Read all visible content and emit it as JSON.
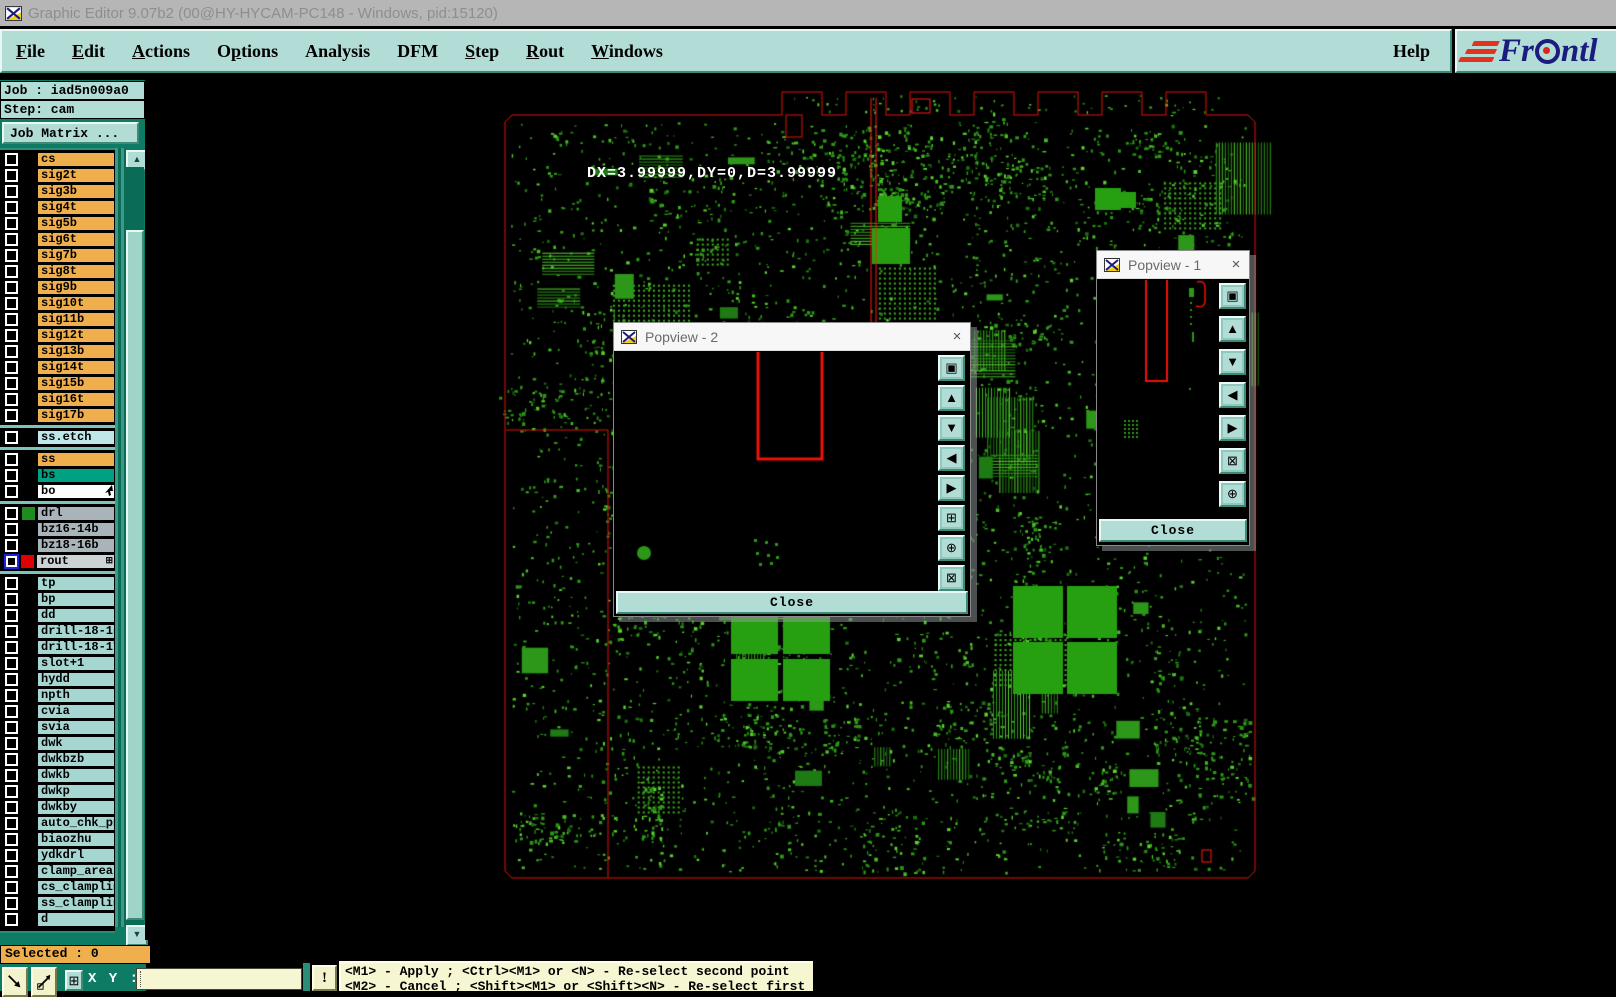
{
  "window": {
    "title": "Graphic Editor 9.07b2 (00@HY-HYCAM-PC148 - Windows, pid:15120)"
  },
  "menu": {
    "items": [
      {
        "label": "File",
        "u": 0
      },
      {
        "label": "Edit",
        "u": 0
      },
      {
        "label": "Actions",
        "u": 0
      },
      {
        "label": "Options",
        "u": 1
      },
      {
        "label": "Analysis",
        "u": -1
      },
      {
        "label": "DFM",
        "u": -1
      },
      {
        "label": "Step",
        "u": 0
      },
      {
        "label": "Rout",
        "u": 0
      },
      {
        "label": "Windows",
        "u": 0
      }
    ],
    "help": {
      "label": "Help"
    }
  },
  "logo": {
    "pre": "Fr",
    "post": "ntl"
  },
  "sidebar": {
    "job": "Job : iad5n009a0",
    "step": "Step: cam",
    "job_matrix": "Job Matrix ...",
    "selected": "Selected : 0",
    "layers": [
      {
        "label": "cs",
        "type": "orange"
      },
      {
        "label": "sig2t",
        "type": "orange"
      },
      {
        "label": "sig3b",
        "type": "orange"
      },
      {
        "label": "sig4t",
        "type": "orange"
      },
      {
        "label": "sig5b",
        "type": "orange"
      },
      {
        "label": "sig6t",
        "type": "orange"
      },
      {
        "label": "sig7b",
        "type": "orange"
      },
      {
        "label": "sig8t",
        "type": "orange"
      },
      {
        "label": "sig9b",
        "type": "orange"
      },
      {
        "label": "sig10t",
        "type": "orange"
      },
      {
        "label": "sig11b",
        "type": "orange"
      },
      {
        "label": "sig12t",
        "type": "orange"
      },
      {
        "label": "sig13b",
        "type": "orange"
      },
      {
        "label": "sig14t",
        "type": "orange"
      },
      {
        "label": "sig15b",
        "type": "orange"
      },
      {
        "label": "sig16t",
        "type": "orange"
      },
      {
        "label": "sig17b",
        "type": "orange"
      },
      {
        "type": "sep"
      },
      {
        "label": "ss.etch",
        "type": "etch"
      },
      {
        "type": "sep"
      },
      {
        "label": "ss",
        "type": "orange"
      },
      {
        "label": "bs",
        "type": "bs"
      },
      {
        "label": "bo",
        "type": "bo",
        "icon": "cursor"
      },
      {
        "type": "sep"
      },
      {
        "label": "drl",
        "type": "gray",
        "swatch": "#1f8c1f"
      },
      {
        "label": "bz16-14b",
        "type": "gray"
      },
      {
        "label": "bz18-16b",
        "type": "gray"
      },
      {
        "label": "rout",
        "type": "rout",
        "swatch": "#e00000",
        "cb": "blue",
        "icon": "grid"
      },
      {
        "type": "sep"
      },
      {
        "label": "tp",
        "type": "teal"
      },
      {
        "label": "bp",
        "type": "teal"
      },
      {
        "label": "dd",
        "type": "teal"
      },
      {
        "label": "drill-18-15",
        "type": "teal"
      },
      {
        "label": "drill-18-17",
        "type": "teal"
      },
      {
        "label": "slot+1",
        "type": "teal"
      },
      {
        "label": "hydd",
        "type": "teal"
      },
      {
        "label": "npth",
        "type": "teal"
      },
      {
        "label": "cvia",
        "type": "teal"
      },
      {
        "label": "svia",
        "type": "teal"
      },
      {
        "label": "dwk",
        "type": "teal"
      },
      {
        "label": "dwkbzb",
        "type": "teal"
      },
      {
        "label": "dwkb",
        "type": "teal"
      },
      {
        "label": "dwkp",
        "type": "teal"
      },
      {
        "label": "dwkby",
        "type": "teal"
      },
      {
        "label": "auto_chk_pnl",
        "type": "teal"
      },
      {
        "label": "biaozhu",
        "type": "teal"
      },
      {
        "label": "ydkdrl",
        "type": "teal"
      },
      {
        "label": "clamp_area",
        "type": "teal"
      },
      {
        "label": "cs_clampline",
        "type": "teal"
      },
      {
        "label": "ss_clampline",
        "type": "teal"
      },
      {
        "label": "d",
        "type": "teal"
      }
    ]
  },
  "canvas": {
    "measurement": "DX=3.99999,DY=0,D=3.99999"
  },
  "popview2": {
    "title": "Popview - 2",
    "close": "Close",
    "close_x": "×",
    "tools": [
      {
        "name": "copy-view",
        "glyph": "▣"
      },
      {
        "name": "pan-up",
        "glyph": "▲"
      },
      {
        "name": "pan-down",
        "glyph": "▼"
      },
      {
        "name": "pan-left",
        "glyph": "◀"
      },
      {
        "name": "pan-right",
        "glyph": "▶"
      },
      {
        "name": "zoom-fit",
        "glyph": "⊞"
      },
      {
        "name": "zoom-in",
        "glyph": "⊕"
      },
      {
        "name": "zoom-home",
        "glyph": "⊠"
      }
    ]
  },
  "popview1": {
    "title": "Popview - 1",
    "close": "Close",
    "close_x": "×",
    "tools": [
      {
        "name": "copy-view",
        "glyph": "▣"
      },
      {
        "name": "pan-up",
        "glyph": "▲"
      },
      {
        "name": "pan-down",
        "glyph": "▼"
      },
      {
        "name": "pan-left",
        "glyph": "◀"
      },
      {
        "name": "pan-right",
        "glyph": "▶"
      },
      {
        "name": "zoom-fit",
        "glyph": "⊠"
      },
      {
        "name": "zoom-in",
        "glyph": "⊕"
      }
    ]
  },
  "statusbar": {
    "xy_label": "X Y :",
    "xy_value": "",
    "alert": "!",
    "line1": "<M1> - Apply  ; <Ctrl><M1> or <N> - Re-select second point",
    "line2": "<M2> - Cancel ; <Shift><M1> or <Shift><N> - Re-select first point"
  },
  "icons": {
    "grid_button": "⊞",
    "scroll_up": "▲",
    "scroll_down": "▼",
    "rout_badge": "⊞"
  }
}
